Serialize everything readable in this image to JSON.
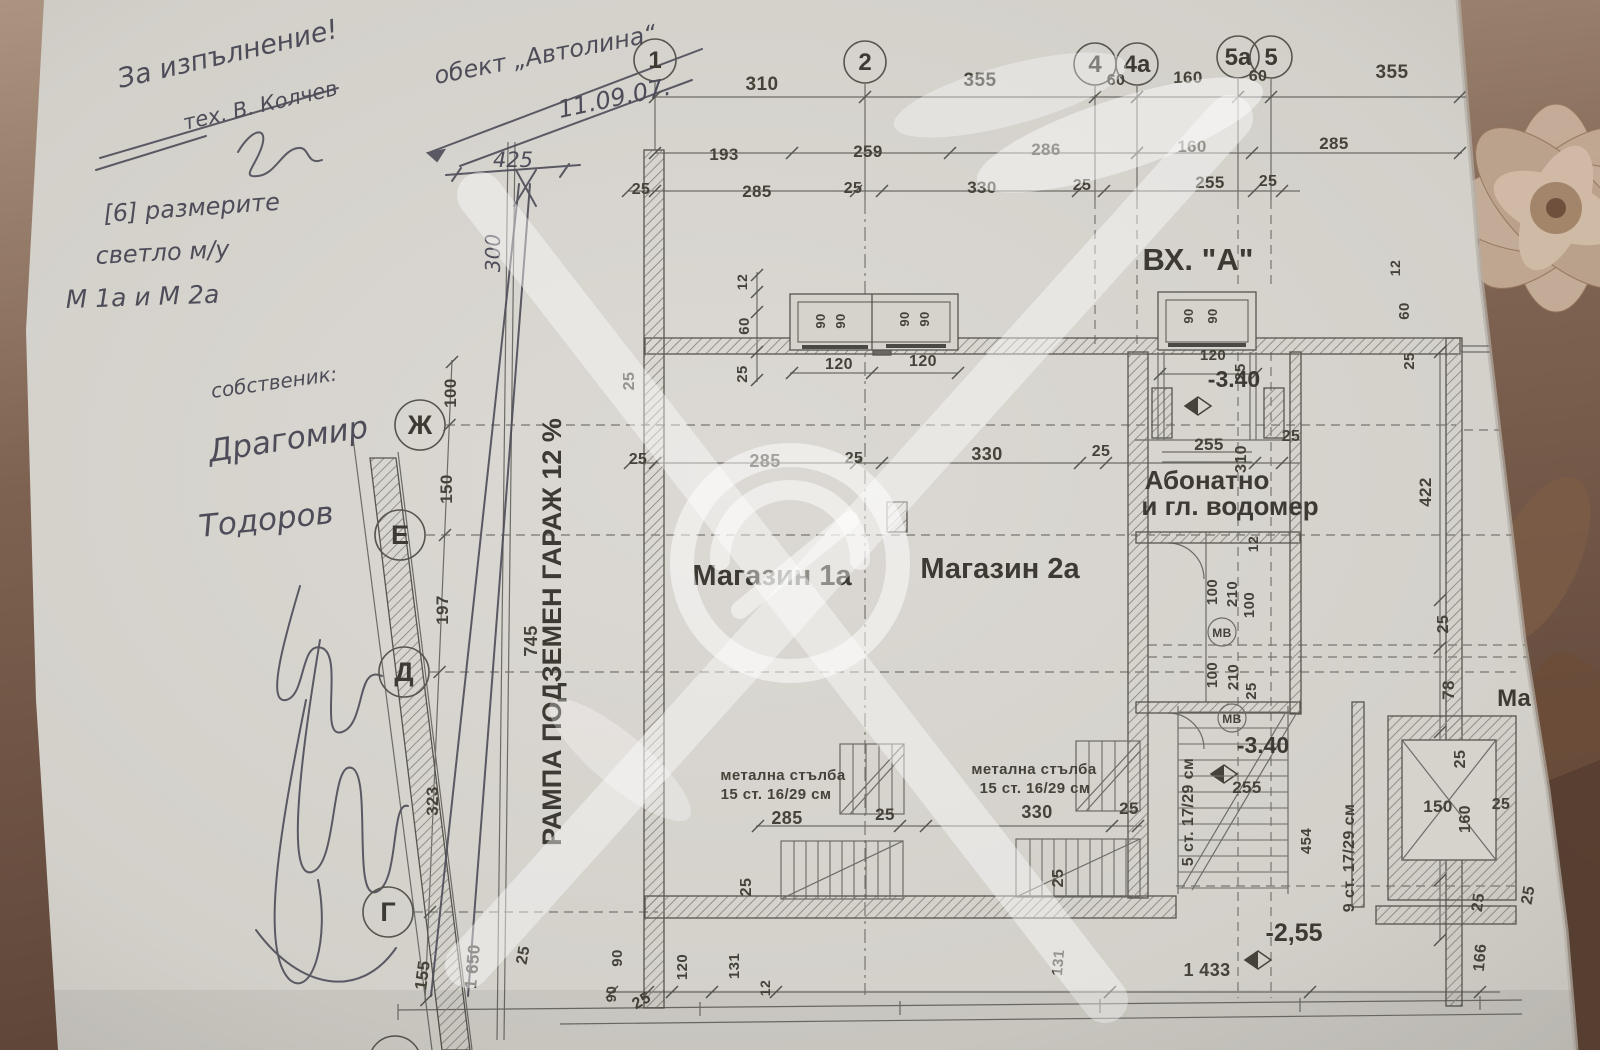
{
  "document_type": "scanned floor plan photo",
  "colors": {
    "paper": "#d6d3cd",
    "fabric_light": "#a8907c",
    "fabric_dark": "#63493a",
    "ink": "#454339",
    "pencil": "#4d4c58",
    "watermark": "#ffffff"
  },
  "handwriting": {
    "approval_line1": "За изпълнение!",
    "approval_line2": "тех. В. Колчев",
    "object_note": "обект „Автолина“",
    "date_note": "11.09.07.",
    "remark_line1": "[6] размерите",
    "remark_line2": "светло м/у",
    "remark_line3": "М 1а и М 2а",
    "owner_label": "собственик:",
    "owner_name_line1": "Драгомир",
    "owner_name_line2": "Тодоров"
  },
  "plan": {
    "entrance_label": "ВХ. \"А\"",
    "shop1_label": "Магазин 1а",
    "shop2_label": "Магазин 2а",
    "shop_partial_label": "Ма",
    "utility_line1": "Абонатно",
    "utility_line2": "и гл. водомер",
    "ramp_label": "РАМПА ПОДЗЕМЕН ГАРАЖ 12 %",
    "water_meter_abbr1": "МВ",
    "water_meter_abbr2": "МВ",
    "stair1_line1": "метална стълба",
    "stair1_line2": "15 ст. 16/29 см",
    "stair2_line1": "метална стълба",
    "stair2_line2": "15 ст. 16/29 см",
    "stair5_label": "5 ст. 17/29 см",
    "stair9_label": "9 ст. 17/29 см",
    "level_entry": "-3.40",
    "level_inner": "-3.40",
    "level_lower": "-2,55"
  },
  "axes": {
    "columns": [
      {
        "label": "1",
        "x": 655,
        "y": 60
      },
      {
        "label": "2",
        "x": 865,
        "y": 62
      },
      {
        "label": "4",
        "x": 1095,
        "y": 64
      },
      {
        "label": "4а",
        "x": 1137,
        "y": 64
      },
      {
        "label": "5а",
        "x": 1238,
        "y": 57
      },
      {
        "label": "5",
        "x": 1271,
        "y": 57
      }
    ],
    "rows": [
      {
        "label": "Ж",
        "x": 420,
        "y": 425
      },
      {
        "label": "Е",
        "x": 400,
        "y": 535
      },
      {
        "label": "Д",
        "x": 404,
        "y": 672
      },
      {
        "label": "Г",
        "x": 388,
        "y": 912
      }
    ]
  },
  "dimensions": [
    {
      "t": "310",
      "x": 762,
      "y": 90
    },
    {
      "t": "355",
      "x": 980,
      "y": 86
    },
    {
      "t": "60",
      "x": 1116,
      "y": 85,
      "s": 16
    },
    {
      "t": "160",
      "x": 1188,
      "y": 83,
      "s": 17
    },
    {
      "t": "60",
      "x": 1258,
      "y": 81,
      "s": 16
    },
    {
      "t": "355",
      "x": 1392,
      "y": 78
    },
    {
      "t": "193",
      "x": 724,
      "y": 160,
      "s": 17
    },
    {
      "t": "259",
      "x": 868,
      "y": 157,
      "s": 17
    },
    {
      "t": "286",
      "x": 1046,
      "y": 155,
      "s": 17
    },
    {
      "t": "160",
      "x": 1192,
      "y": 152,
      "s": 17
    },
    {
      "t": "285",
      "x": 1334,
      "y": 149,
      "s": 17
    },
    {
      "t": "25",
      "x": 641,
      "y": 194,
      "s": 16
    },
    {
      "t": "285",
      "x": 757,
      "y": 197,
      "s": 17
    },
    {
      "t": "25",
      "x": 853,
      "y": 193,
      "s": 16
    },
    {
      "t": "330",
      "x": 982,
      "y": 193,
      "s": 17
    },
    {
      "t": "25",
      "x": 1082,
      "y": 190,
      "s": 16
    },
    {
      "t": "255",
      "x": 1210,
      "y": 188,
      "s": 17
    },
    {
      "t": "25",
      "x": 1268,
      "y": 186,
      "s": 16
    },
    {
      "t": "425",
      "x": 513,
      "y": 167,
      "s": 21,
      "h": true
    },
    {
      "t": "300",
      "x": 500,
      "y": 253,
      "r": -90,
      "s": 20,
      "h": true
    },
    {
      "t": "100",
      "x": 456,
      "y": 393,
      "r": -90,
      "s": 17
    },
    {
      "t": "150",
      "x": 452,
      "y": 489,
      "r": -90,
      "s": 17
    },
    {
      "t": "197",
      "x": 448,
      "y": 610,
      "r": -90,
      "s": 17
    },
    {
      "t": "323",
      "x": 438,
      "y": 801,
      "r": -90,
      "s": 17
    },
    {
      "t": "155",
      "x": 428,
      "y": 976,
      "r": -82,
      "s": 17
    },
    {
      "t": "1 650",
      "x": 478,
      "y": 967,
      "r": -85,
      "s": 17
    },
    {
      "t": "25",
      "x": 528,
      "y": 956,
      "r": -80,
      "s": 16
    },
    {
      "t": "745",
      "x": 537,
      "y": 641,
      "r": -90,
      "s": 18
    },
    {
      "t": "25",
      "x": 634,
      "y": 381,
      "r": -90,
      "s": 16
    },
    {
      "t": "12",
      "x": 747,
      "y": 282,
      "r": -90,
      "s": 14
    },
    {
      "t": "60",
      "x": 749,
      "y": 326,
      "r": -90,
      "s": 15
    },
    {
      "t": "25",
      "x": 747,
      "y": 374,
      "r": -90,
      "s": 15
    },
    {
      "t": "90",
      "x": 825,
      "y": 321,
      "r": -90,
      "s": 13
    },
    {
      "t": "90",
      "x": 845,
      "y": 321,
      "r": -90,
      "s": 13
    },
    {
      "t": "90",
      "x": 909,
      "y": 319,
      "r": -90,
      "s": 13
    },
    {
      "t": "90",
      "x": 929,
      "y": 319,
      "r": -90,
      "s": 13
    },
    {
      "t": "120",
      "x": 839,
      "y": 369,
      "s": 16
    },
    {
      "t": "120",
      "x": 923,
      "y": 366,
      "s": 16
    },
    {
      "t": "90",
      "x": 1193,
      "y": 316,
      "r": -90,
      "s": 13
    },
    {
      "t": "90",
      "x": 1217,
      "y": 316,
      "r": -90,
      "s": 13
    },
    {
      "t": "120",
      "x": 1213,
      "y": 360,
      "s": 15
    },
    {
      "t": "25",
      "x": 1245,
      "y": 372,
      "r": -90,
      "s": 15
    },
    {
      "t": "25",
      "x": 638,
      "y": 464,
      "s": 16
    },
    {
      "t": "285",
      "x": 765,
      "y": 467,
      "s": 18
    },
    {
      "t": "25",
      "x": 854,
      "y": 463,
      "s": 16
    },
    {
      "t": "330",
      "x": 987,
      "y": 460,
      "s": 18
    },
    {
      "t": "25",
      "x": 1101,
      "y": 456,
      "s": 16
    },
    {
      "t": "255",
      "x": 1209,
      "y": 450,
      "s": 17
    },
    {
      "t": "310",
      "x": 1246,
      "y": 459,
      "r": -90,
      "s": 16
    },
    {
      "t": "25",
      "x": 1291,
      "y": 441,
      "s": 16
    },
    {
      "t": "12",
      "x": 1400,
      "y": 268,
      "r": -90,
      "s": 14
    },
    {
      "t": "60",
      "x": 1409,
      "y": 311,
      "r": -90,
      "s": 15
    },
    {
      "t": "25",
      "x": 1414,
      "y": 361,
      "r": -90,
      "s": 15
    },
    {
      "t": "422",
      "x": 1431,
      "y": 492,
      "r": -90,
      "s": 17
    },
    {
      "t": "25",
      "x": 1448,
      "y": 624,
      "r": -90,
      "s": 16
    },
    {
      "t": "78",
      "x": 1454,
      "y": 690,
      "r": -90,
      "s": 17
    },
    {
      "t": "12",
      "x": 1258,
      "y": 544,
      "r": -90,
      "s": 14
    },
    {
      "t": "100",
      "x": 1217,
      "y": 592,
      "r": -90,
      "s": 15
    },
    {
      "t": "210",
      "x": 1237,
      "y": 594,
      "r": -90,
      "s": 15
    },
    {
      "t": "100",
      "x": 1254,
      "y": 605,
      "r": -90,
      "s": 15
    },
    {
      "t": "100",
      "x": 1217,
      "y": 675,
      "r": -90,
      "s": 15
    },
    {
      "t": "210",
      "x": 1238,
      "y": 677,
      "r": -90,
      "s": 15
    },
    {
      "t": "25",
      "x": 1256,
      "y": 691,
      "r": -90,
      "s": 15
    },
    {
      "t": "255",
      "x": 1247,
      "y": 793,
      "s": 17
    },
    {
      "t": "454",
      "x": 1311,
      "y": 841,
      "r": -90,
      "s": 15
    },
    {
      "t": "150",
      "x": 1438,
      "y": 812,
      "s": 17
    },
    {
      "t": "160",
      "x": 1470,
      "y": 819,
      "r": -90,
      "s": 16
    },
    {
      "t": "25",
      "x": 1501,
      "y": 809,
      "s": 16
    },
    {
      "t": "25",
      "x": 1465,
      "y": 759,
      "r": -90,
      "s": 16
    },
    {
      "t": "25",
      "x": 1483,
      "y": 903,
      "r": -82,
      "s": 16
    },
    {
      "t": "25",
      "x": 1533,
      "y": 896,
      "r": -80,
      "s": 16
    },
    {
      "t": "285",
      "x": 787,
      "y": 824,
      "s": 18
    },
    {
      "t": "25",
      "x": 885,
      "y": 820,
      "s": 17
    },
    {
      "t": "330",
      "x": 1037,
      "y": 818,
      "s": 18
    },
    {
      "t": "25",
      "x": 1129,
      "y": 814,
      "s": 17
    },
    {
      "t": "25",
      "x": 751,
      "y": 887,
      "r": -90,
      "s": 16
    },
    {
      "t": "25",
      "x": 1063,
      "y": 878,
      "r": -90,
      "s": 16
    },
    {
      "t": "90",
      "x": 622,
      "y": 958,
      "r": -90,
      "s": 15
    },
    {
      "t": "90",
      "x": 616,
      "y": 994,
      "r": -90,
      "s": 14
    },
    {
      "t": "25",
      "x": 644,
      "y": 1005,
      "r": -30,
      "s": 16
    },
    {
      "t": "120",
      "x": 687,
      "y": 967,
      "r": -90,
      "s": 15
    },
    {
      "t": "131",
      "x": 739,
      "y": 966,
      "r": -90,
      "s": 15
    },
    {
      "t": "12",
      "x": 770,
      "y": 988,
      "r": -90,
      "s": 14
    },
    {
      "t": "131",
      "x": 1063,
      "y": 963,
      "r": -85,
      "s": 15
    },
    {
      "t": "1 433",
      "x": 1207,
      "y": 976,
      "s": 18
    },
    {
      "t": "166",
      "x": 1485,
      "y": 958,
      "r": -85,
      "s": 16
    }
  ]
}
